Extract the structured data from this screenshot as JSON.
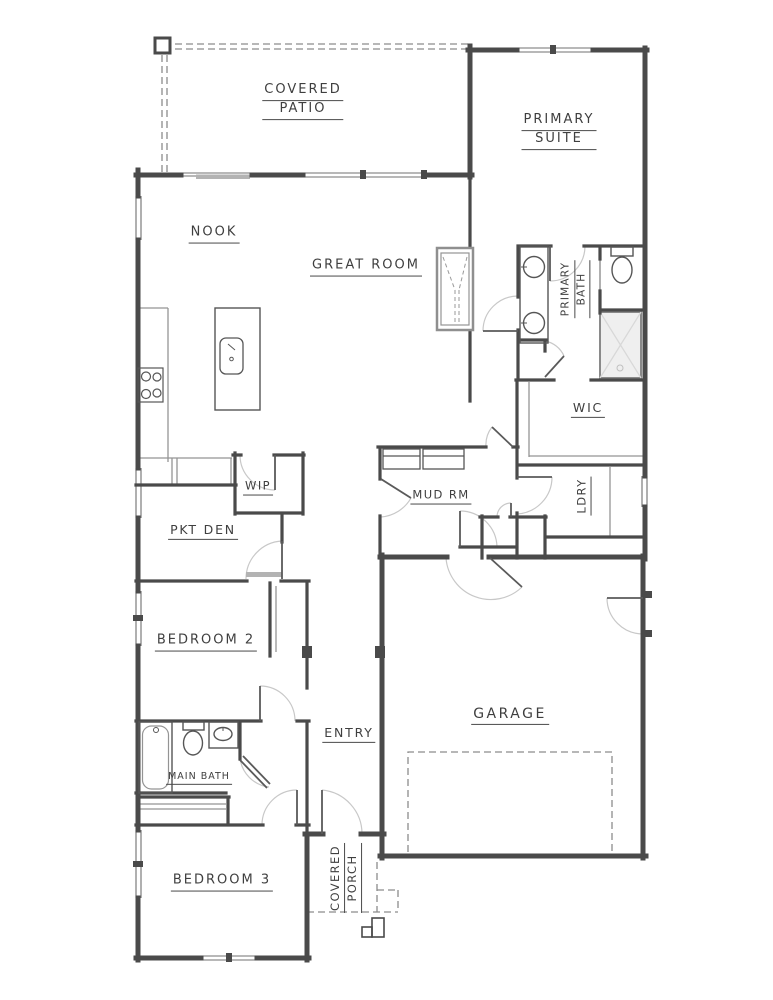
{
  "rooms": {
    "covered_patio": [
      "COVERED",
      "PATIO"
    ],
    "primary_suite": [
      "PRIMARY",
      "SUITE"
    ],
    "nook": [
      "NOOK"
    ],
    "great_room": [
      "GREAT ROOM"
    ],
    "primary_bath": [
      "PRIMARY",
      "BATH"
    ],
    "wic": [
      "WIC"
    ],
    "ldry": [
      "LDRY"
    ],
    "mud_rm": [
      "MUD RM"
    ],
    "wip": [
      "WIP"
    ],
    "pkt_den": [
      "PKT DEN"
    ],
    "bedroom_2": [
      "BEDROOM 2"
    ],
    "entry": [
      "ENTRY"
    ],
    "main_bath": [
      "MAIN BATH"
    ],
    "garage": [
      "GARAGE"
    ],
    "bedroom_3": [
      "BEDROOM 3"
    ],
    "covered_porch": [
      "COVERED",
      "PORCH"
    ]
  },
  "colors": {
    "wall": "#4a4a4a",
    "line": "#949494",
    "window": "#707070",
    "arc": "#c8c8c8",
    "dash": "#8c8c8c",
    "fixture": "#565656",
    "panel": "#b3b3b3",
    "shower": "#efefef",
    "text": "#3f3f3f",
    "bg": "#ffffff"
  }
}
